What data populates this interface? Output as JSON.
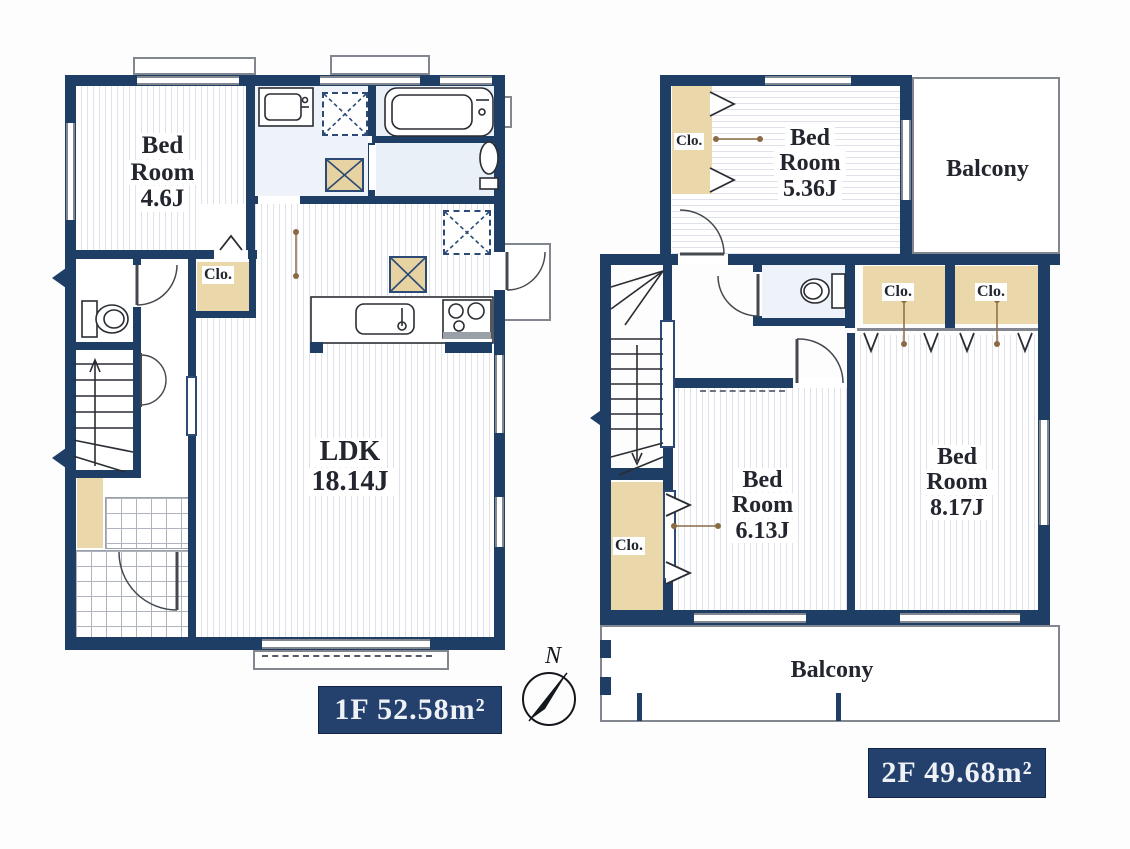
{
  "colors": {
    "wall": "#1f3e66",
    "closet_fill": "#ead8ab",
    "floor_stripe": "#dfe2ea",
    "bath_floor": "#e9f0f7",
    "badge_bg": "#24416e",
    "badge_text": "#eef1f6"
  },
  "compass": {
    "label": "N"
  },
  "floor1": {
    "badge": "1F 52.58m²",
    "bedroom": {
      "line1": "Bed",
      "line2": "Room",
      "line3": "4.6J"
    },
    "closet": "Clo.",
    "ldk": {
      "line1": "LDK",
      "line2": "18.14J"
    }
  },
  "floor2": {
    "badge": "2F 49.68m²",
    "bedroom_536": {
      "line1": "Bed",
      "line2": "Room",
      "line3": "5.36J"
    },
    "bedroom_613": {
      "line1": "Bed",
      "line2": "Room",
      "line3": "6.13J"
    },
    "bedroom_817": {
      "line1": "Bed",
      "line2": "Room",
      "line3": "8.17J"
    },
    "closet_top": "Clo.",
    "closet_mid_left": "Clo.",
    "closet_mid_right": "Clo.",
    "closet_bottom": "Clo.",
    "balcony_top": "Balcony",
    "balcony_bottom": "Balcony"
  }
}
